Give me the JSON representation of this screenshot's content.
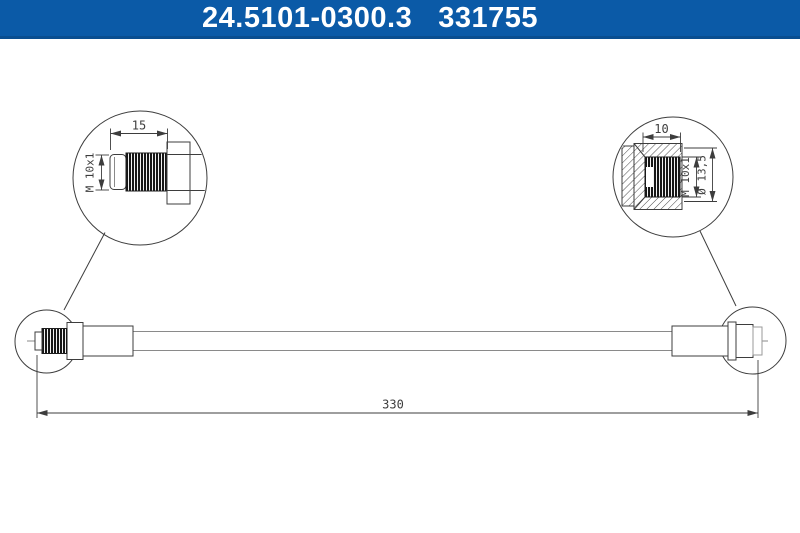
{
  "header": {
    "part_number": "24.5101-0300.3",
    "reference_number": "331755",
    "bg_color": "#0b5aa7",
    "edge_color": "#0a4e90",
    "text_color": "#ffffff"
  },
  "drawing": {
    "line_color": "#3d3d3d",
    "left_detail": {
      "length_dim": "15",
      "thread_dim": "M 10x1"
    },
    "right_detail": {
      "length_dim": "10",
      "thread_dim": "M 10x1",
      "diameter_dim": "Ø 13,5"
    },
    "main_view": {
      "overall_length_dim": "330"
    }
  }
}
